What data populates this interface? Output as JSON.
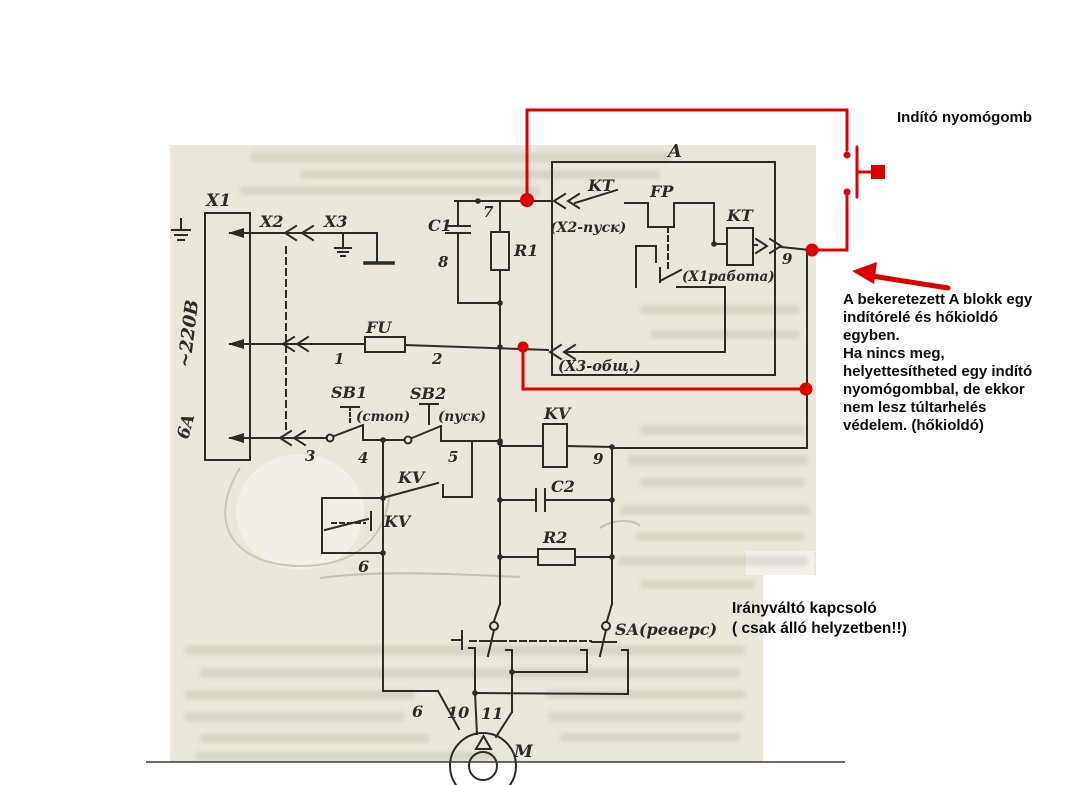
{
  "colors": {
    "paper": "#eae6d9",
    "ink": "#2b2b27",
    "accent_red": "#dd0000",
    "annotation_text": "#0d0d0d"
  },
  "annotations": {
    "start_button_label": "Indító nyomógomb",
    "block_note_lines": [
      "A bekeretezett A blokk egy",
      "indítórelé és hőkioldó",
      "egyben.",
      "Ha nincs meg,",
      "helyettesítheted egy indító",
      "nyomógombbal, de ekkor",
      "nem lesz túltarhelés",
      "védelem. (hőkioldó)"
    ],
    "reverser_note_lines": [
      "Irányváltó kapcsoló",
      "( csak álló helyzetben!!)"
    ]
  },
  "schematic": {
    "power": {
      "voltage": "~220B",
      "fuse_rating": "6A"
    },
    "labels": {
      "x1": "X1",
      "x2": "X2",
      "x3": "X3",
      "c1": "C1",
      "r1": "R1",
      "n7": "7",
      "n8": "8",
      "block": "A",
      "kt_contact": "KT",
      "fp": "FP",
      "kt_coil": "KT",
      "x2_pusk": "(X2-пуск)",
      "x1_rabota": "(X1работа)",
      "x3_obsh": "(X3-общ.)",
      "n9": "9",
      "fu": "FU",
      "n1": "1",
      "n2": "2",
      "sb1": "SB1",
      "stop": "(стоп)",
      "sb2": "SB2",
      "pusk": "(пуск)",
      "n3": "3",
      "n4": "4",
      "n5": "5",
      "kv_contact1": "KV",
      "kv_contact2": "KV",
      "kv_coil": "KV",
      "n9b": "9",
      "c2": "C2",
      "r2": "R2",
      "n6": "6",
      "sa": "SA(реверс)",
      "n6m": "6",
      "n10": "10",
      "n11": "11",
      "m": "M"
    }
  }
}
